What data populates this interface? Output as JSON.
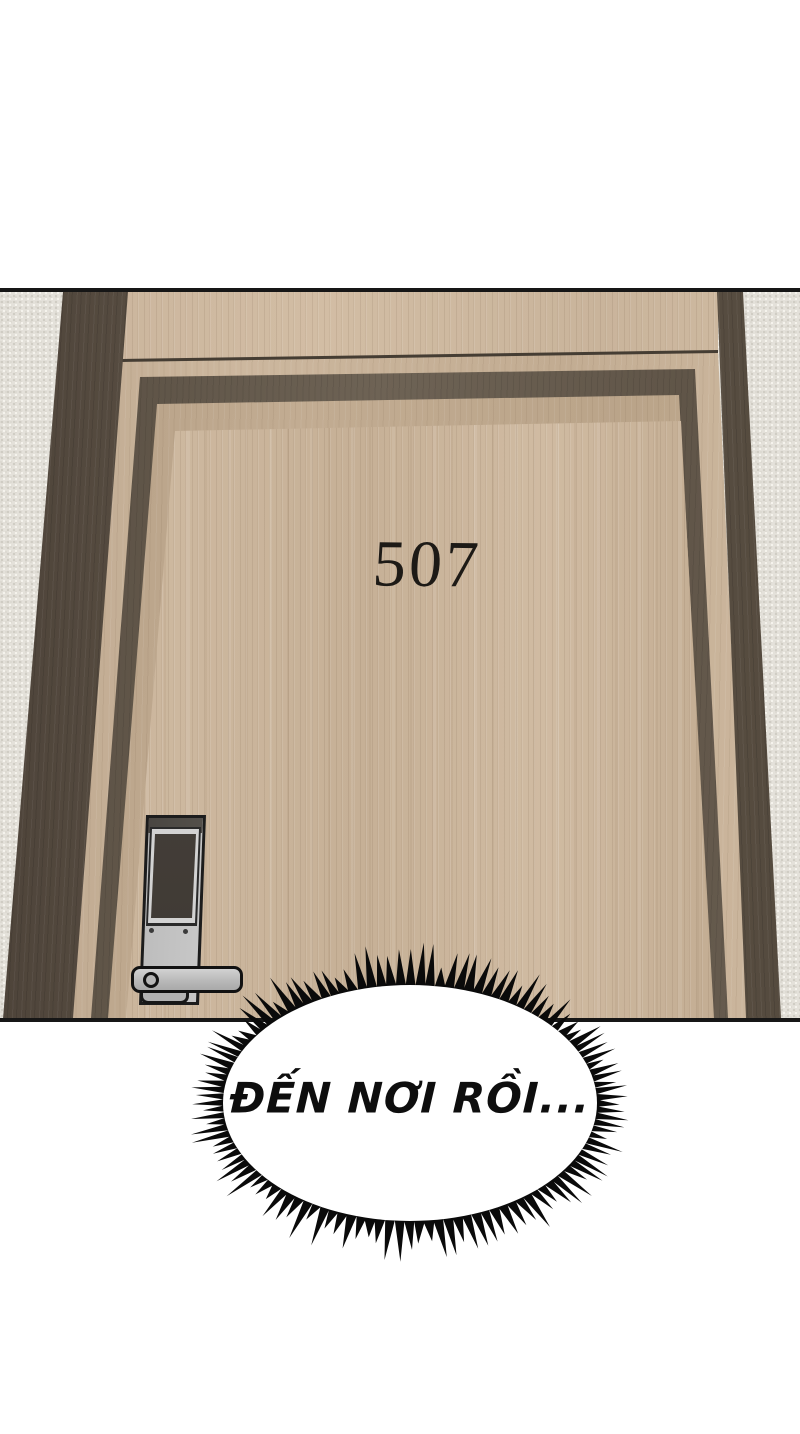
{
  "panel": {
    "door_number": "507",
    "colors": {
      "wall": "#e4e1da",
      "frame_dark_brown": "#5f5447",
      "door_wood": "#c9b399",
      "lock_silver": "#c0c0c0",
      "lock_screen": "#4a443f",
      "outline_black": "#161616"
    }
  },
  "bubble": {
    "text": "ĐẾN NƠI RỒI...",
    "fill": "#ffffff",
    "spike_color": "#0a0a0a"
  }
}
